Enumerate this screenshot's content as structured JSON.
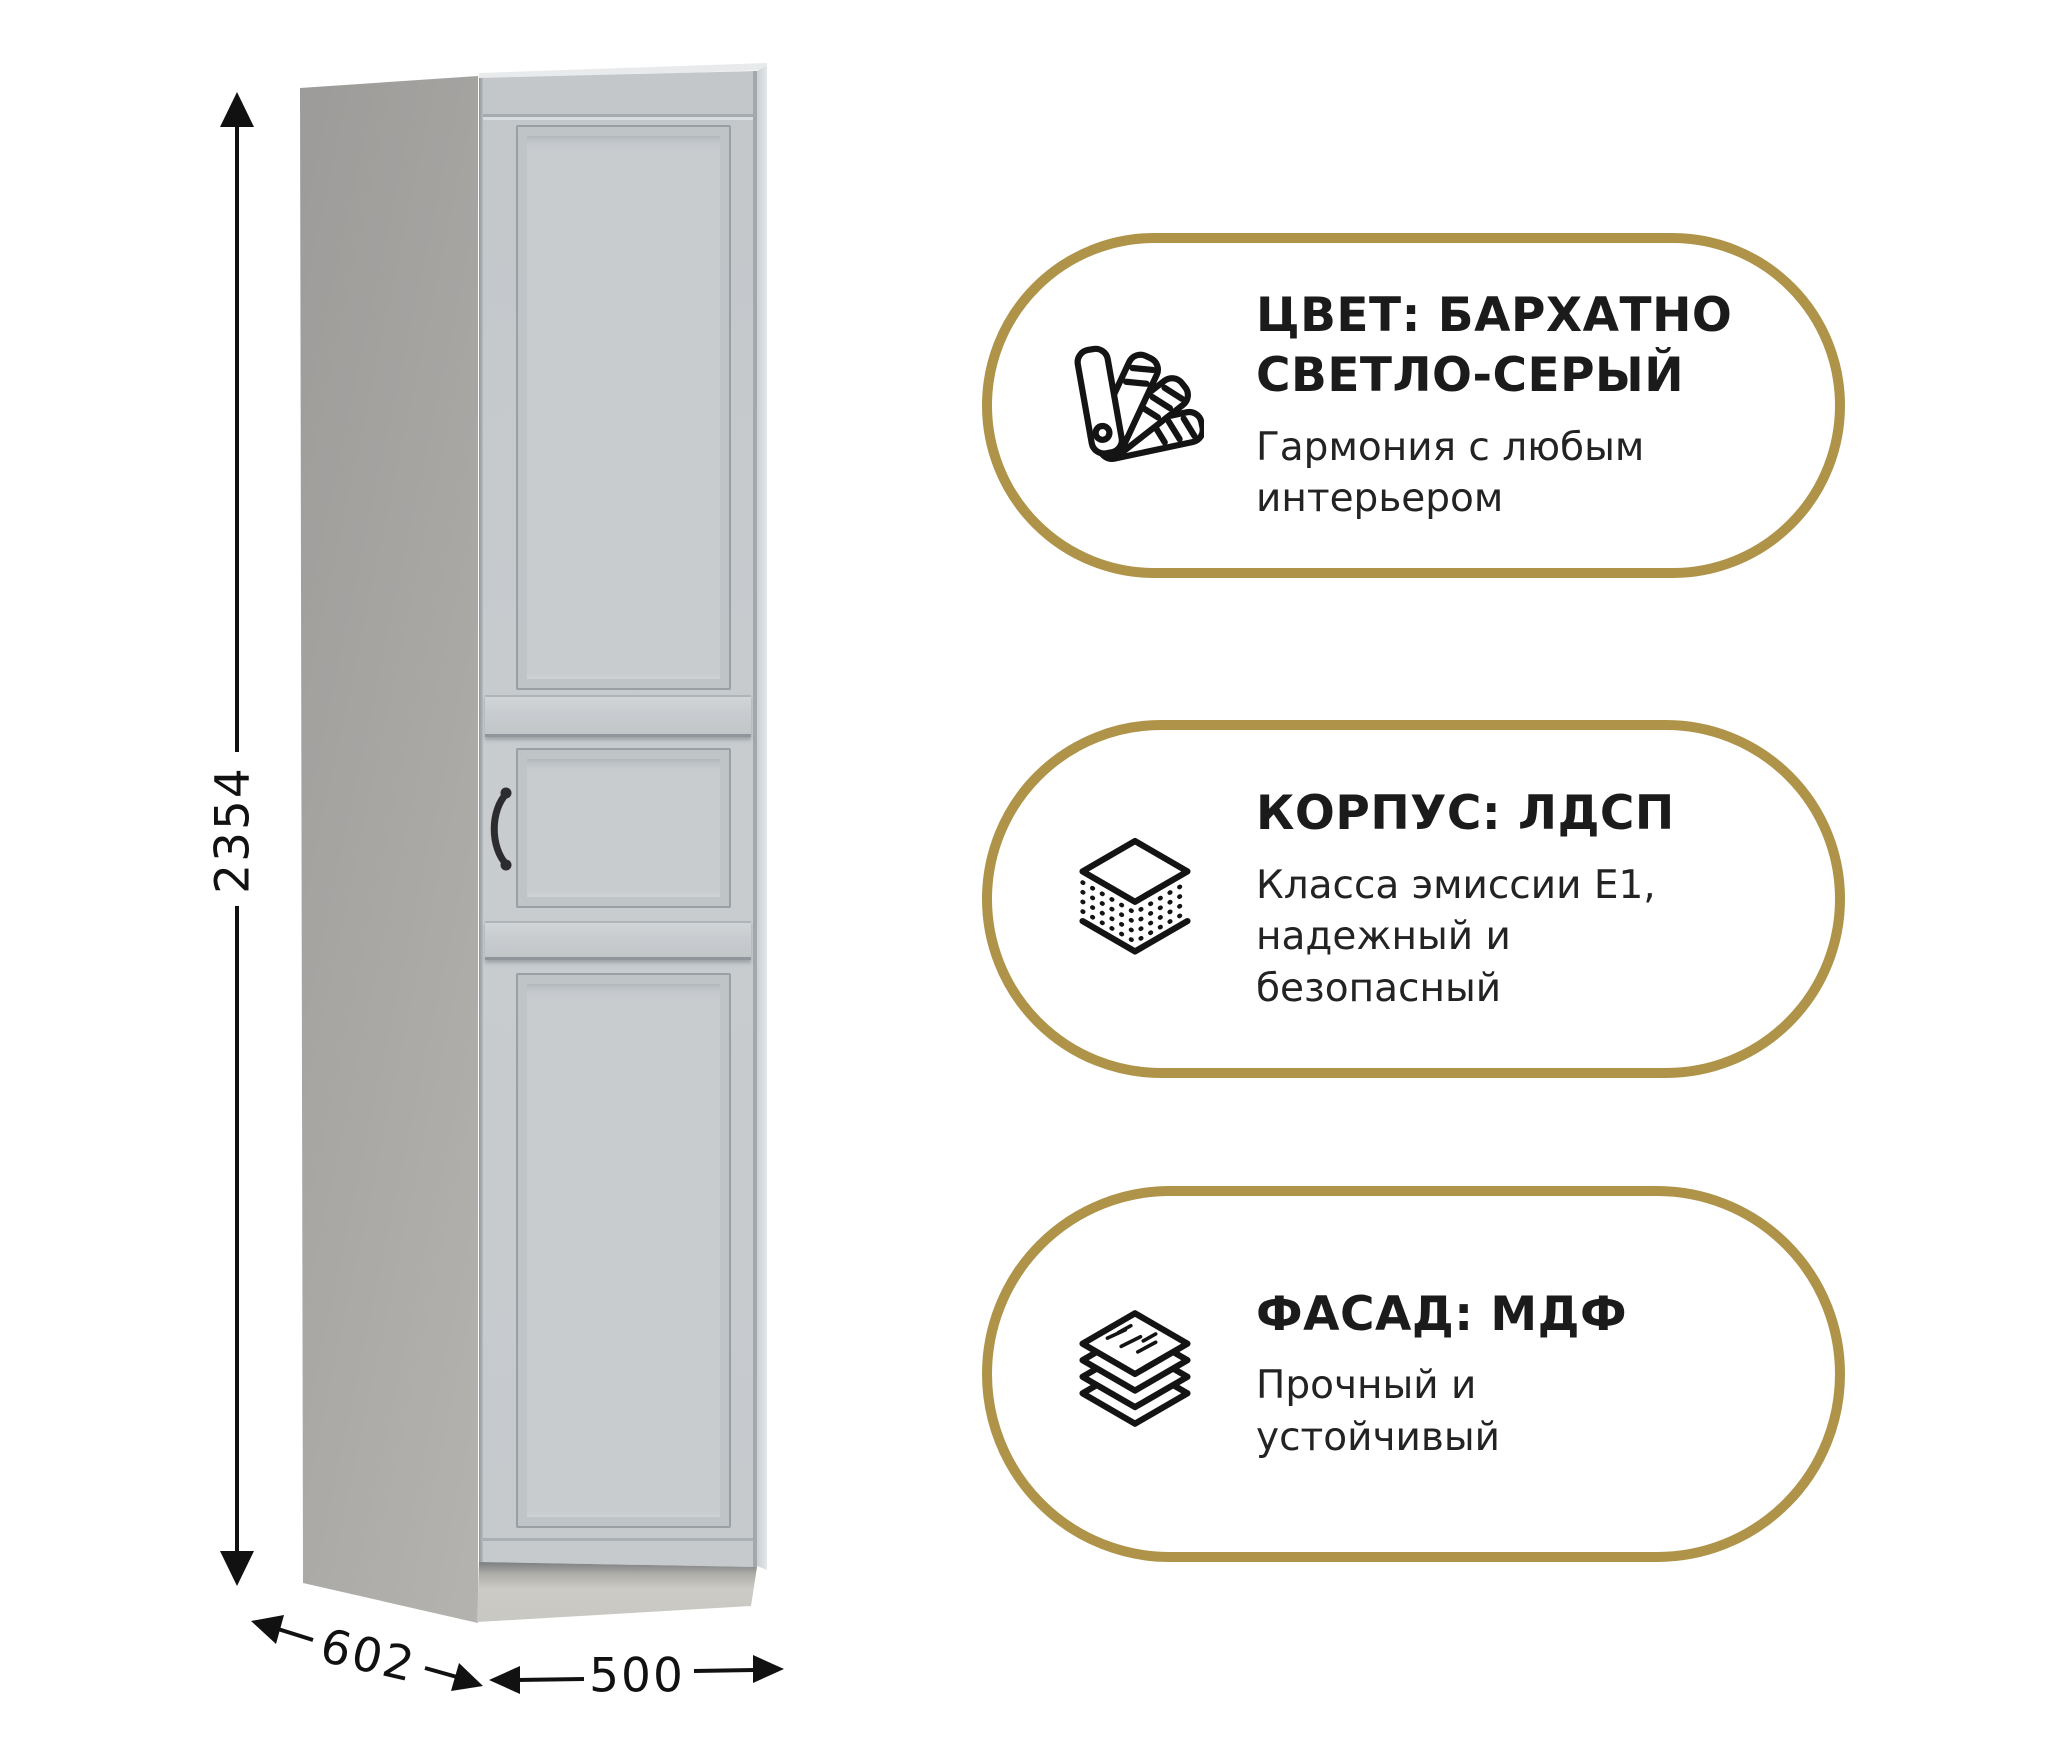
{
  "product": {
    "dimensions": {
      "height": "2354",
      "depth": "602",
      "width": "500"
    }
  },
  "badges": [
    {
      "icon": "color-swatches-icon",
      "title_lines": [
        "ЦВЕТ: БАРХАТНО",
        "СВЕТЛО-СЕРЫЙ"
      ],
      "subtitle_lines": [
        "Гармония с любым",
        "интерьером"
      ]
    },
    {
      "icon": "board-layers-icon",
      "title_lines": [
        "КОРПУС: ЛДСП"
      ],
      "subtitle_lines": [
        "Класса эмиссии Е1,",
        "надежный и",
        "безопасный"
      ]
    },
    {
      "icon": "stacked-sheets-icon",
      "title_lines": [
        "ФАСАД: МДФ"
      ],
      "subtitle_lines": [
        "Прочный и",
        "устойчивый"
      ]
    }
  ],
  "colors": {
    "accent_gold": "#AE9348",
    "text": "#1B1B1B",
    "cabinet_side": "#A9A8A5",
    "cabinet_door": "#C6CACD",
    "cabinet_plinth": "#CCCBC6"
  }
}
